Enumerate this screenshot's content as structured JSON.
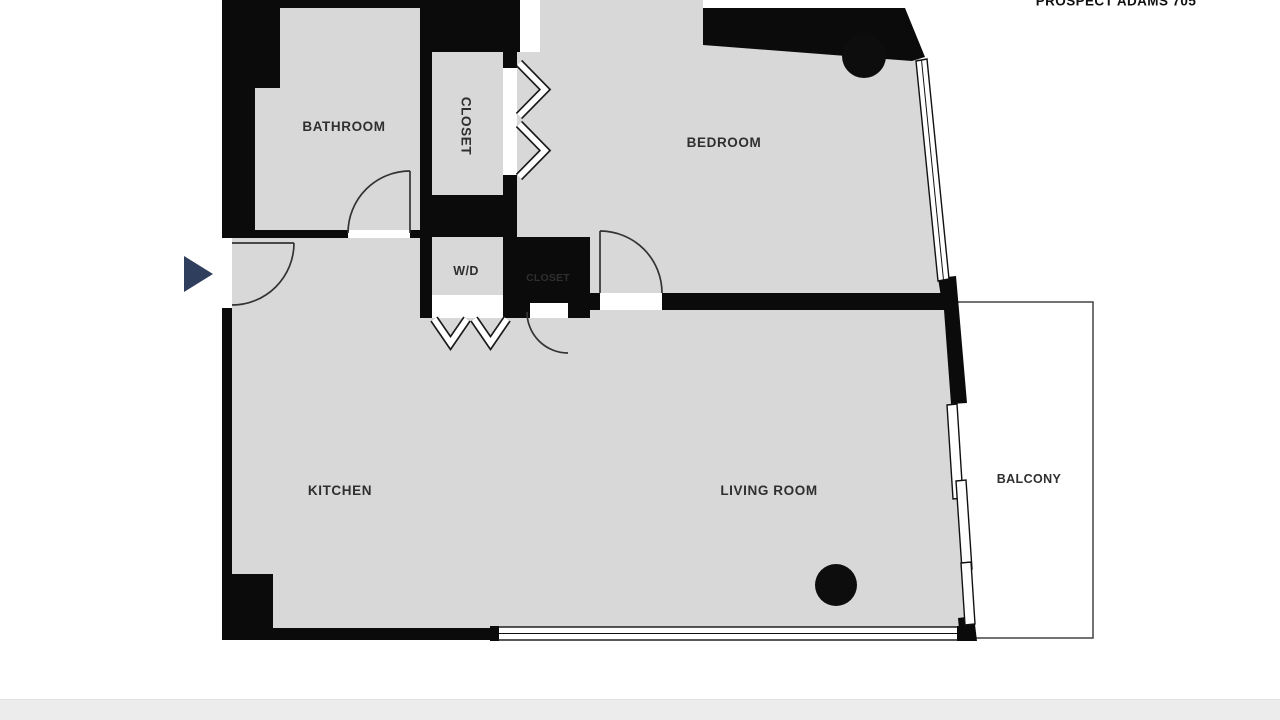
{
  "header": {
    "title": "PROSPECT ADAMS 705"
  },
  "floorplan": {
    "rooms": {
      "bathroom": {
        "label": "BATHROOM"
      },
      "closet_hall": {
        "label": "CLOSET"
      },
      "bedroom": {
        "label": "BEDROOM"
      },
      "wd": {
        "label": "W/D"
      },
      "closet_small": {
        "label": "CLOSET"
      },
      "kitchen": {
        "label": "KITCHEN"
      },
      "living_room": {
        "label": "LIVING ROOM"
      },
      "balcony": {
        "label": "BALCONY"
      }
    },
    "colors": {
      "wall": "#0b0b0b",
      "room_fill": "#d8d8d8",
      "entry_marker": "#2f3e5d",
      "window_fill": "#ffffff",
      "footer_bar": "#ececec",
      "label_text": "#2f2f2f",
      "background": "#ffffff"
    },
    "markers": {
      "entry_arrow": "entry direction arrow",
      "columns": 2
    }
  }
}
